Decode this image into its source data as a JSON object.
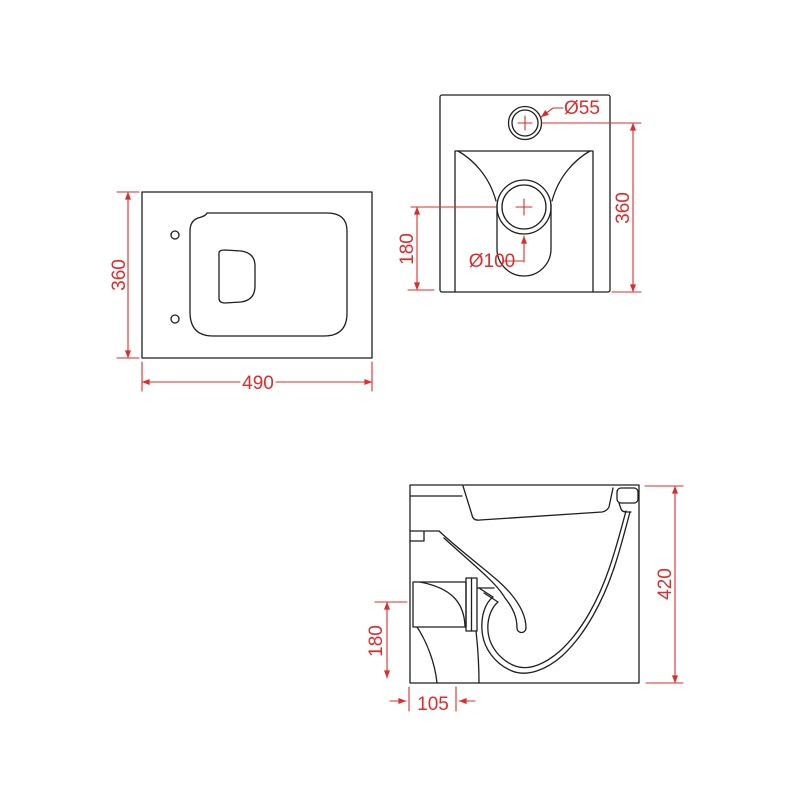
{
  "page": {
    "background": "#ffffff"
  },
  "drawing": {
    "line_color": "#1f1f1f",
    "dim_color": "#e02b2b",
    "plan_view": {
      "width_label": "490",
      "depth_label": "360"
    },
    "back_view": {
      "height_label": "360",
      "drain_center_label": "180",
      "inlet_diameter_label": "Ø55",
      "drain_diameter_label": "Ø100"
    },
    "side_view": {
      "height_label": "420",
      "outlet_center_label": "180",
      "outlet_offset_label": "105"
    }
  }
}
